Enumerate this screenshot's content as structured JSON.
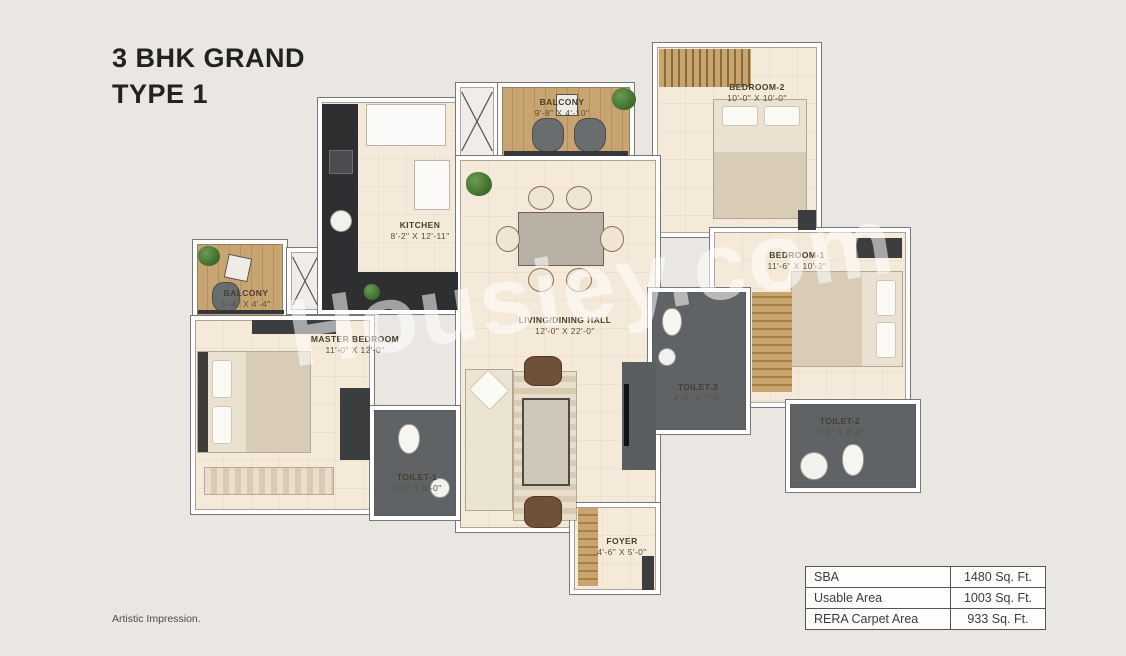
{
  "title": {
    "line1": "3 BHK GRAND",
    "line2": "TYPE 1"
  },
  "watermark": "Housiey.com",
  "footnote": "Artistic Impression.",
  "rooms": {
    "balcony_top": {
      "name": "BALCONY",
      "dims": "9'-8\" X 4'-10\""
    },
    "bedroom2": {
      "name": "BEDROOM-2",
      "dims": "10'-0\" X 10'-0\""
    },
    "kitchen": {
      "name": "KITCHEN",
      "dims": "8'-2\" X 12'-11\""
    },
    "balcony_left": {
      "name": "BALCONY",
      "dims": "5'-4\" X 4'-4\""
    },
    "master_bedroom": {
      "name": "MASTER BEDROOM",
      "dims": "11'-0\" X 12'-0\""
    },
    "living": {
      "name": "LIVING/DINING HALL",
      "dims": "12'-0\" X 22'-0\""
    },
    "bedroom1": {
      "name": "BEDROOM-1",
      "dims": "11'-6\" X 10'-2\""
    },
    "toilet3": {
      "name": "TOILET-3",
      "dims": "4'-6\" X 7'-6\""
    },
    "toilet2": {
      "name": "TOILET-2",
      "dims": "7'-6\" X 4'-6\""
    },
    "toilet1": {
      "name": "TOILET-1",
      "dims": "5'-0\" X 8'-0\""
    },
    "foyer": {
      "name": "FOYER",
      "dims": "4'-6\" X 5'-0\""
    }
  },
  "area_table": {
    "rows": [
      {
        "label": "SBA",
        "value": "1480 Sq. Ft."
      },
      {
        "label": "Usable Area",
        "value": "1003 Sq. Ft."
      },
      {
        "label": "RERA Carpet Area",
        "value": "933 Sq. Ft."
      }
    ]
  },
  "colors": {
    "background": "#eae6e1",
    "floor": "#f5e9d9",
    "wall": "#ffffff",
    "toilet_floor": "#5f6365",
    "wood": "#c8a471",
    "counter": "#2e2f30",
    "title_text": "#222222"
  }
}
